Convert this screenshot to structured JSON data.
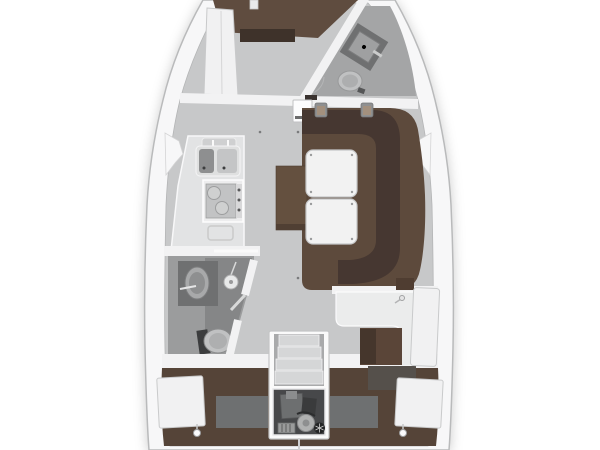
{
  "plan": {
    "type": "sailboat-interior-floorplan",
    "view": "top-down",
    "regions": [
      "forward-v-berth-cabin",
      "forward-head-bathroom",
      "salon-with-l-settee-and-folding-table",
      "galley-with-double-sink-and-stove",
      "aft-head-with-shower",
      "navigation-station",
      "companionway-steps",
      "engine-compartment",
      "aft-berth-cabin"
    ]
  },
  "colors": {
    "background": "#ffffff",
    "hull": "#f7f7f8",
    "hull_edge": "#b9babb",
    "floor_salon": "#c7c8c9",
    "floor_head_fwd": "#a4a5a6",
    "floor_bath": "#9b9c9d",
    "floor_shower": "#858687",
    "berth_fwd": "#5f4c3f",
    "berth_fwd_dark": "#3e322a",
    "settee": "#5d4a3c",
    "settee_back": "#463731",
    "bench": "#64503f",
    "berth_aft": "#554438",
    "panel_gray": "#6e7071",
    "wall_white": "#f2f2f3",
    "furniture_white": "#f1f1f2",
    "furniture_edge": "#c9cacb",
    "table": "#f2f2f2",
    "counter": "#e2e3e4",
    "sink_dark": "#8e8f90",
    "sink_light": "#c4c5c6",
    "stove_top": "#c2c3c4",
    "fixture_dark": "#6f7071",
    "fixture_mid": "#9fa0a1",
    "toilet": "#c0c1c2",
    "seat_nav": "#5a4538",
    "seat_nav_dark": "#45362c",
    "desk_brown": "#4f3d31",
    "chart_table": "#ebecec",
    "opening_dark": "#55504b",
    "steps": "#d5d6d7",
    "steps_shadow": "#a9aaab",
    "engine_floor": "#47484a",
    "engine_block": "#6d6f70",
    "engine_light": "#b0b1b1",
    "engine_dark": "#242526",
    "engine_detail": "#9a9b9b",
    "headrest": "#a3907e",
    "clip_gray": "#8f9091",
    "handle_white": "#fbfbfc"
  }
}
